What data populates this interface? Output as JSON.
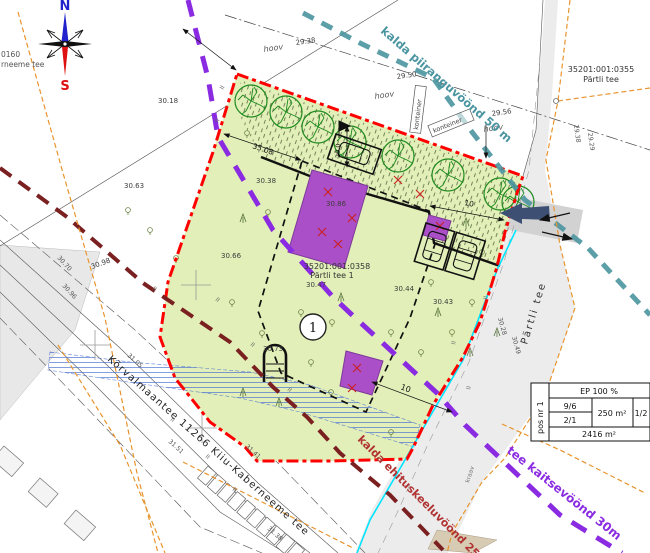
{
  "compass": {
    "n": "N",
    "s": "S"
  },
  "zones": {
    "shore_limit": "kalda piiranguvöönd 50 m",
    "road_protect": "tee kaitsevöönd 30m",
    "shore_build_ban": "kalda ehituskeeluvöönd 25m"
  },
  "roads": {
    "main": "Kõrvalmaantee 11266 Kiiu-Kaberneeme tee",
    "partli": "Pärtli tee",
    "ditch": "kraav",
    "edge_cut_1": "0160",
    "edge_cut_2": "rneeme tee"
  },
  "parcels": {
    "p355_code": "35201:001:0355",
    "p355_name": "Pärtli tee",
    "p358_code": "35201:001:0358",
    "p358_name": "Pärtli tee 1",
    "p358_elev": "30.47"
  },
  "marker_1": "1",
  "site": {
    "hoov": "hoov",
    "konteiner": "konteiner"
  },
  "dimensions": {
    "top_edge": "35.08",
    "depth": "20.0",
    "setback_e": "10",
    "setback_s": "10"
  },
  "info_table": {
    "header": "EP 100 %",
    "pos": "pos nr 1",
    "ratio1": "9/6",
    "ratio2": "2/1",
    "build_area": "250 m²",
    "ratio3": "1/2",
    "plot_area": "2416 m²"
  },
  "elevations": {
    "e1": "30.18",
    "e2": "29.38",
    "e3": "29.50",
    "e4": "29.56",
    "e5": "30.63",
    "e6": "30.38",
    "e7": "30.86",
    "e8": "30.66",
    "e9": "30.73",
    "e10": "30.44",
    "e11": "30.43",
    "e12": "30.98",
    "e13": "30.96",
    "e14": "30.70",
    "e15": "31.05",
    "e16": "31.51",
    "e17": "31.41",
    "e18": "31.38",
    "e19": "29.38",
    "e20": "29.29",
    "e21": "30.28",
    "e22": "30.49"
  },
  "colors": {
    "boundary": "#ff0000",
    "building": "#ab4fc8",
    "shore_limit_line": "#4a95a0",
    "road_protect_line": "#8a2be2",
    "shore_ban_line": "#7a2020",
    "utility_line": "#e8942d",
    "water_line": "#00e5ff",
    "plot_fill": "#e2efb8"
  }
}
